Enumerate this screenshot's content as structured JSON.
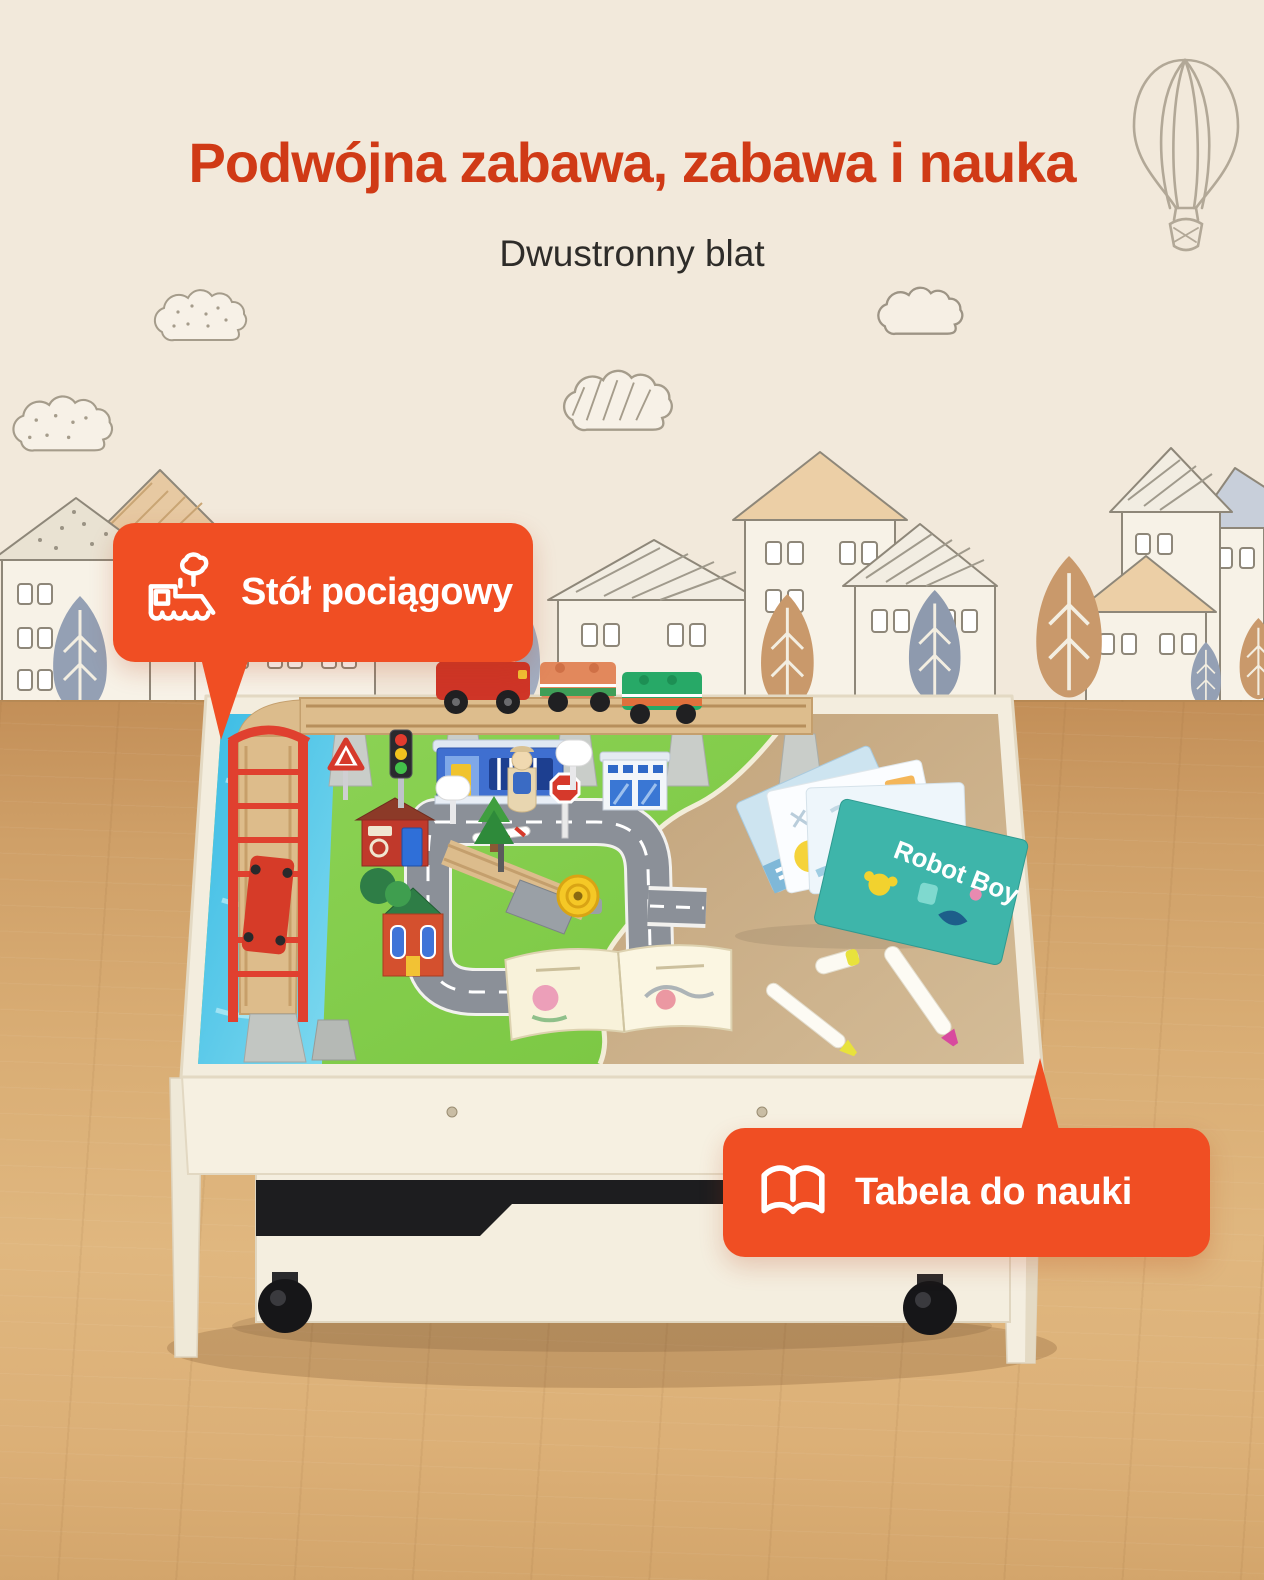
{
  "header": {
    "title": "Podwójna zabawa, zabawa i nauka",
    "subtitle": "Dwustronny blat"
  },
  "callouts": {
    "train_table": {
      "label": "Stół pociągowy",
      "icon": "steam-train-icon"
    },
    "learning_table": {
      "label": "Tabela do nauki",
      "icon": "open-book-icon"
    }
  },
  "tabletop": {
    "books": {
      "gdzie_cover_title": "Gdzie?",
      "robot_cover_title": "Robot Boy"
    }
  },
  "colors": {
    "accent_orange": "#F04E23",
    "title_red": "#D03A16",
    "subtitle_dark": "#2E2C29",
    "wall_cream": "#F2E9DB",
    "floor_wood": "#D9AD74",
    "table_wood_white": "#F4EEDF",
    "play_mat_green": "#84CF4C",
    "water_blue": "#45C0E4",
    "learning_surface_tan": "#C8AB85"
  }
}
